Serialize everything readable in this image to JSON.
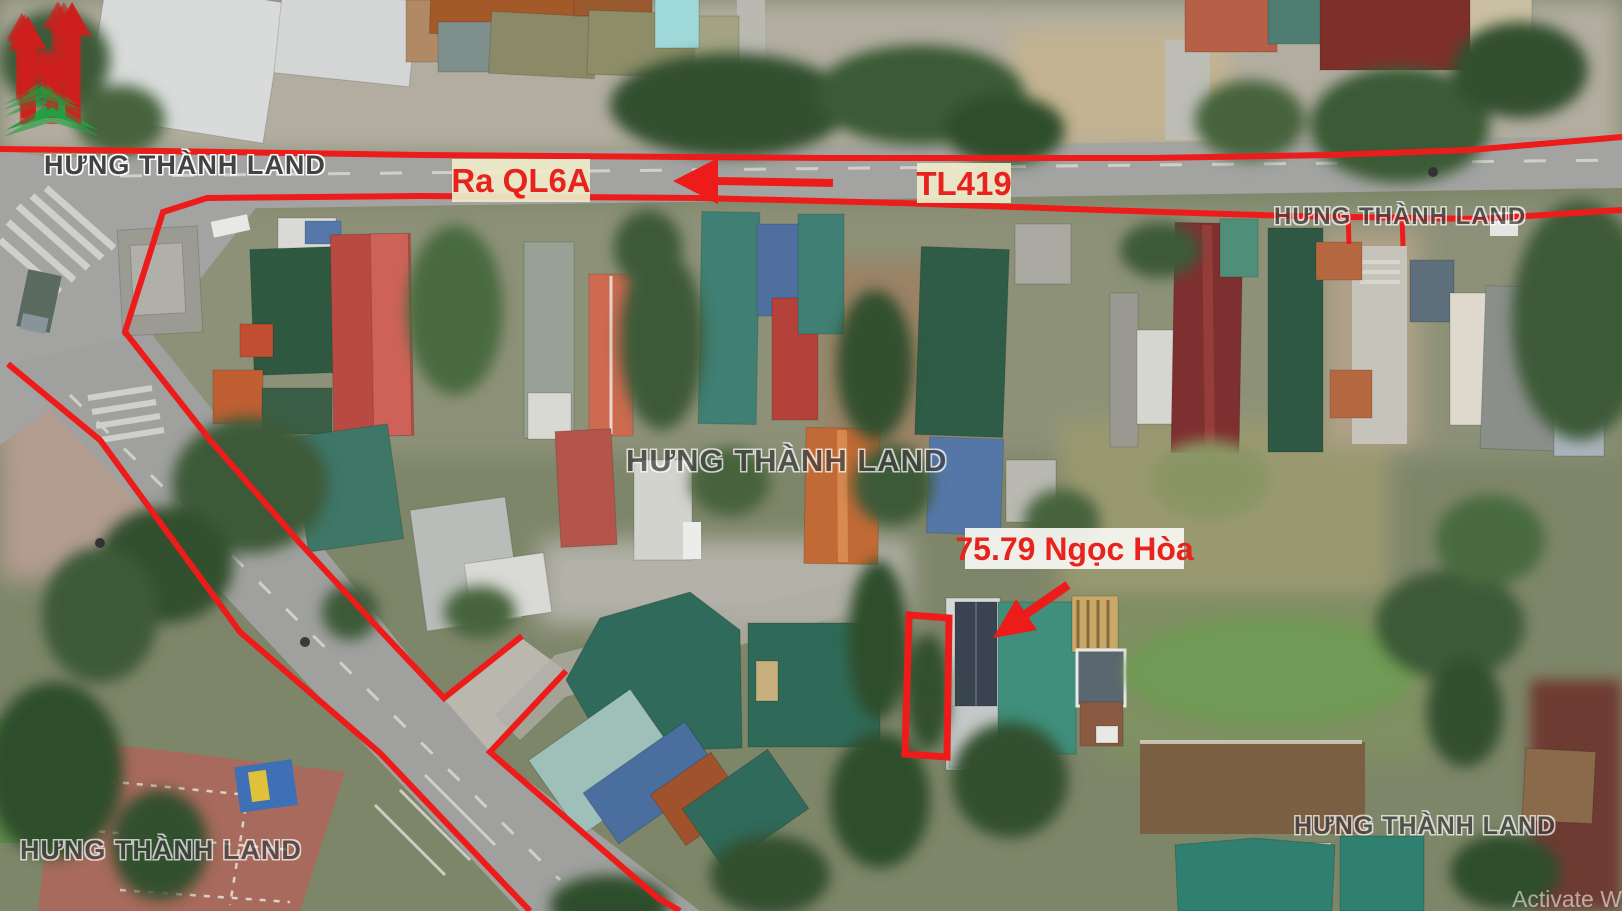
{
  "scene": {
    "type": "aerial-drone-photo",
    "description": "Aerial view of residential land plots along provincial road TL419 with a red-outlined plot for sale"
  },
  "labels": {
    "direction": "Ra QL6A",
    "route": "TL419",
    "plot": "75.79 Ngọc Hòa"
  },
  "watermarks": {
    "brand": "HƯNG THÀNH LAND",
    "positions": [
      "top-left",
      "right",
      "center",
      "bottom-left",
      "bottom-right"
    ]
  },
  "system": {
    "activation": "Activate Win"
  },
  "colors": {
    "annotation_red": "#ee1b1b",
    "label_text_red": "#e8221c",
    "label_bg_cream": "rgba(238,236,201,0.92)",
    "label_bg_white": "rgba(248,248,244,0.92)",
    "watermark_text": "#3d3d3d",
    "logo_red": "#cf1f1d",
    "logo_green": "#1fa03f",
    "road_gray": "#a3a3a1",
    "tree_green": "#3d5a38"
  }
}
